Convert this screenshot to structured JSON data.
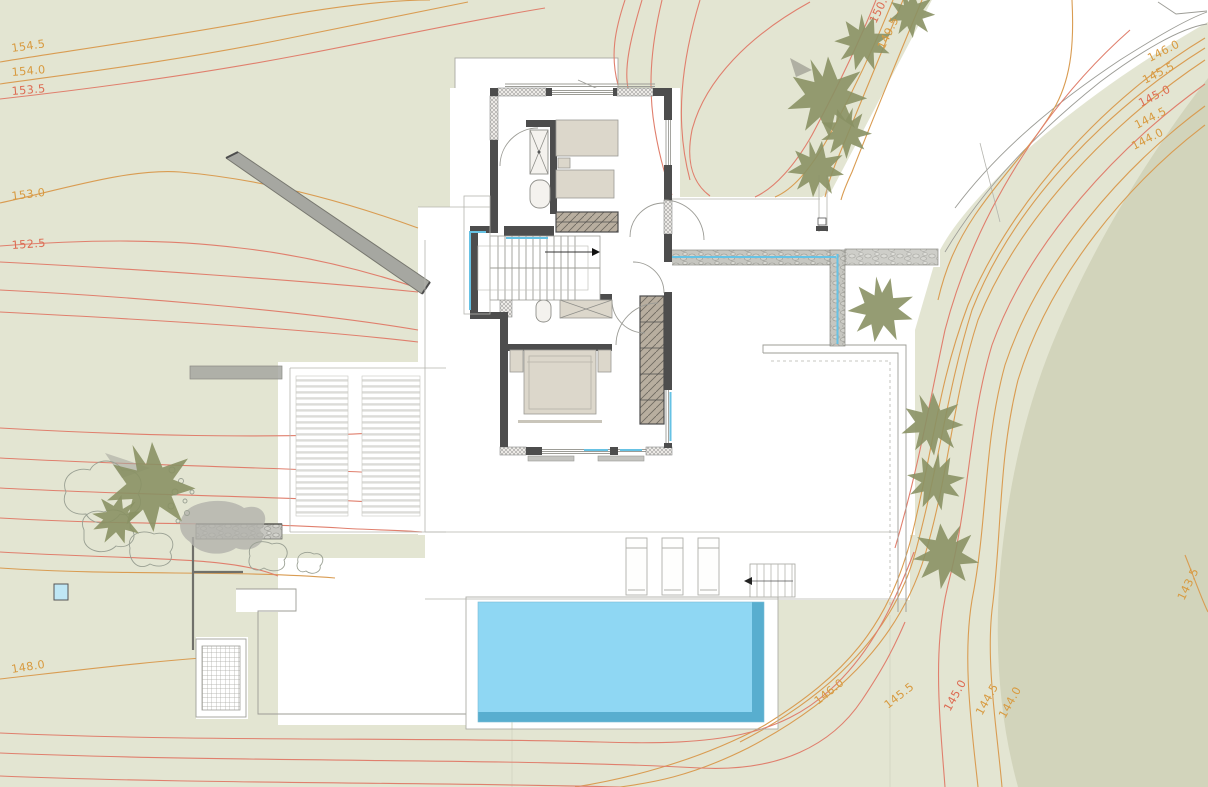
{
  "drawing": {
    "type": "architectural-site-plan",
    "content": "hillside villa upper floor plan with pool, terraces, pergola, trees and terrain contour lines"
  },
  "colors": {
    "background": "#e3e5d2",
    "terrain_dark": "#d2d4bb",
    "white_plot": "#ffffff",
    "contour_orange": "#d99c52",
    "contour_red": "#e07f6d",
    "label_orange": "#d89a3f",
    "label_red": "#dd6b52",
    "pool_fill": "#8fd7f3",
    "pool_edge": "#58aecf",
    "tree_fill": "#8a9164",
    "wall_fill": "#4d4d4d",
    "water_accent": "#66c2e4",
    "stone_wall": "#c6c6c0"
  },
  "icons": {
    "tree": "spiky-star-shape",
    "stair_direction_arrow": "black triangle ▶",
    "exterior_stair_arrow": "black triangle ◀",
    "shower": "rectangle with X diagonals",
    "wardrobe": "hatched rectangle"
  },
  "contour_labels": [
    {
      "value": "154.5",
      "color": "orange"
    },
    {
      "value": "154.0",
      "color": "orange"
    },
    {
      "value": "153.5",
      "color": "red"
    },
    {
      "value": "153.0",
      "color": "orange"
    },
    {
      "value": "152.5",
      "color": "red"
    },
    {
      "value": "148.0",
      "color": "orange"
    },
    {
      "value": "150.0",
      "color": "red"
    },
    {
      "value": "149.5",
      "color": "orange"
    },
    {
      "value": "146.0",
      "color": "orange"
    },
    {
      "value": "145.5",
      "color": "orange"
    },
    {
      "value": "145.0",
      "color": "red"
    },
    {
      "value": "144.5",
      "color": "orange"
    },
    {
      "value": "144.0",
      "color": "orange"
    },
    {
      "value": "143.5",
      "color": "orange"
    },
    {
      "value": "146.0",
      "color": "orange"
    },
    {
      "value": "145.5",
      "color": "orange"
    },
    {
      "value": "145.0",
      "color": "red"
    },
    {
      "value": "144.5",
      "color": "orange"
    },
    {
      "value": "144.0",
      "color": "orange"
    }
  ]
}
